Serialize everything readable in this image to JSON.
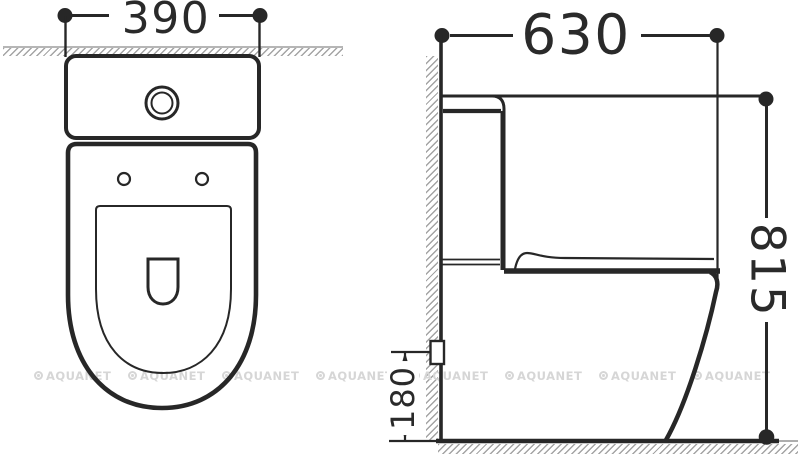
{
  "drawing": {
    "dimensions": {
      "width": "390",
      "depth": "630",
      "height": "815",
      "outlet_height": "180"
    }
  },
  "watermark": {
    "text": "AQUANET"
  },
  "colors": {
    "background": "#ffffff",
    "line": "#272727",
    "hatch": "#a4a4a4",
    "watermark": "#d6d6d6"
  }
}
